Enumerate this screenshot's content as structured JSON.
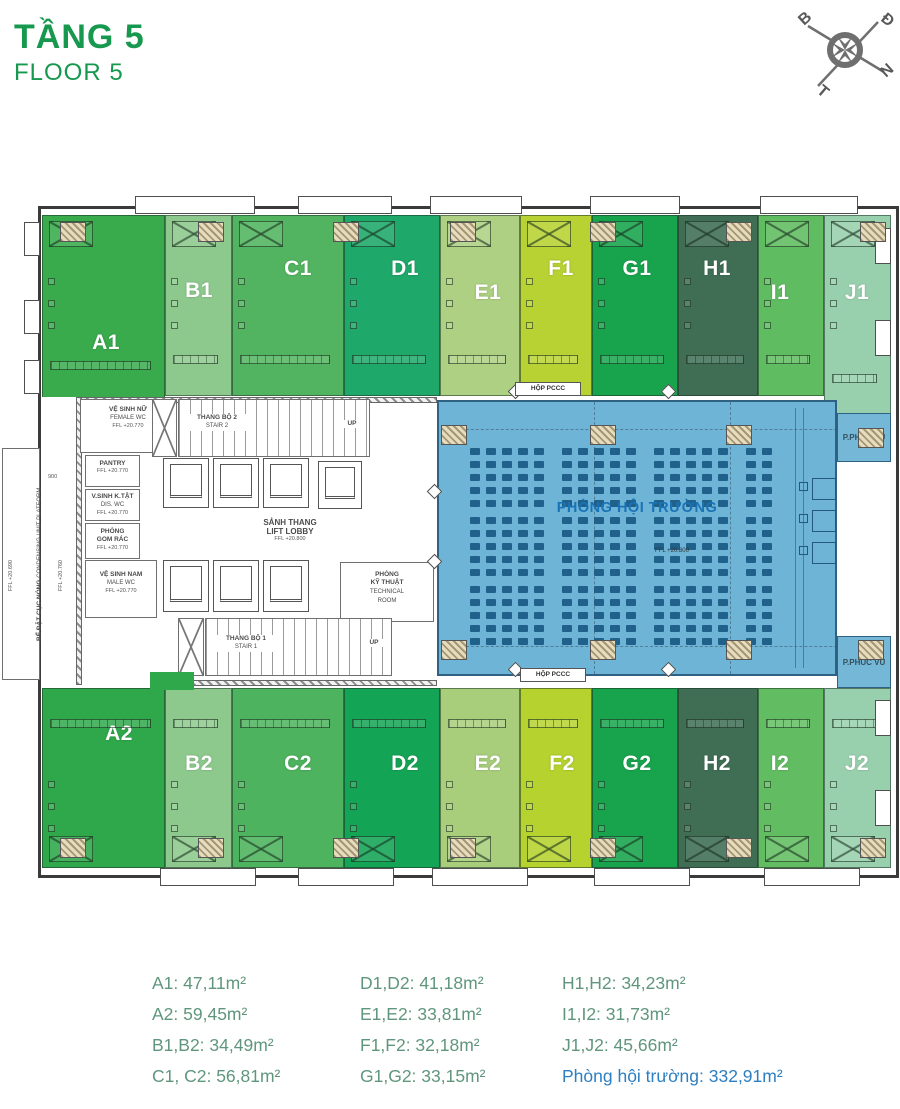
{
  "title": {
    "main": "TẦNG 5",
    "sub": "FLOOR 5",
    "color": "#16984f"
  },
  "compass": {
    "letters": [
      "B",
      "Đ",
      "N",
      "T"
    ]
  },
  "units": [
    {
      "id": "A1",
      "label": "A1",
      "color": "#39ab4d"
    },
    {
      "id": "B1",
      "label": "B1",
      "color": "#8dc98d"
    },
    {
      "id": "C1",
      "label": "C1",
      "color": "#52b460"
    },
    {
      "id": "D1",
      "label": "D1",
      "color": "#1ea86a"
    },
    {
      "id": "E1",
      "label": "E1",
      "color": "#aed083"
    },
    {
      "id": "F1",
      "label": "F1",
      "color": "#b8d233"
    },
    {
      "id": "G1",
      "label": "G1",
      "color": "#18a44d"
    },
    {
      "id": "H1",
      "label": "H1",
      "color": "#3f6e55"
    },
    {
      "id": "I1",
      "label": "I1",
      "color": "#60bc61"
    },
    {
      "id": "J1",
      "label": "J1",
      "color": "#98d0ad"
    },
    {
      "id": "A2",
      "label": "A2",
      "color": "#2fa84b"
    },
    {
      "id": "B2",
      "label": "B2",
      "color": "#8dc98d"
    },
    {
      "id": "C2",
      "label": "C2",
      "color": "#4db35e"
    },
    {
      "id": "D2",
      "label": "D2",
      "color": "#14a455"
    },
    {
      "id": "E2",
      "label": "E2",
      "color": "#a8ce7c"
    },
    {
      "id": "F2",
      "label": "F2",
      "color": "#b6d22f"
    },
    {
      "id": "G2",
      "label": "G2",
      "color": "#18a44d"
    },
    {
      "id": "H2",
      "label": "H2",
      "color": "#3f6e55"
    },
    {
      "id": "I2",
      "label": "I2",
      "color": "#62bd62"
    },
    {
      "id": "J2",
      "label": "J2",
      "color": "#98d0ad"
    }
  ],
  "hall": {
    "label": "PHÒNG HỘI TRƯỜNG",
    "ffl": "FFL +20.800",
    "color": "#6db4d6",
    "seat_color": "#20618c",
    "label_color": "#1a73b6",
    "service_color": "#74b7d7",
    "service_top": "P.PHUC VU",
    "service_bottom": "P.PHUC VU"
  },
  "core": {
    "female_wc": {
      "vi": "VỆ SINH NỮ",
      "en": "FEMALE WC",
      "ffl": "FFL +20.770"
    },
    "stair2": {
      "vi": "THANG BỘ 2",
      "en": "STAIR 2",
      "up": "UP"
    },
    "pantry": {
      "vi": "PANTRY",
      "ffl": "FFL +20.770"
    },
    "dis_wc": {
      "vi": "V.SINH K.TẬT",
      "en": "DIS. WC",
      "ffl": "FFL +20.770"
    },
    "gom_rac": {
      "vi1": "PHÒNG",
      "vi2": "GOM RÁC",
      "ffl": "FFL +20.770"
    },
    "lift_lobby": {
      "vi": "SẢNH THANG",
      "en": "LIFT LOBBY",
      "ffl": "FFL +20.800"
    },
    "male_wc": {
      "vi": "VỆ SINH NAM",
      "en": "MALE WC",
      "ffl": "FFL +20.770"
    },
    "technical": {
      "vi1": "PHÒNG",
      "vi2": "KỸ THUẬT",
      "en1": "TECHNICAL",
      "en2": "ROOM"
    },
    "stair1": {
      "vi": "THANG BỘ 1",
      "en": "STAIR 1",
      "up": "UP"
    },
    "condensing": {
      "vi": "BỂ ĐẶT CỤC NÓNG",
      "en": "CONDENSING UNIT PLATFORM"
    },
    "ffl_left1": "FFL +20.690",
    "ffl_left2": "FFL +20.760",
    "dim": "900"
  },
  "labels": {
    "hop_pccc_top": "HỘP PCCC",
    "hop_pccc_bottom": "HỘP PCCC"
  },
  "legend": {
    "color": "#5f967d",
    "highlight_color": "#2d7fc1",
    "col1": [
      "A1: 47,11m²",
      "A2: 59,45m²",
      "B1,B2: 34,49m²",
      "C1, C2: 56,81m²"
    ],
    "col2": [
      "D1,D2: 41,18m²",
      "E1,E2: 33,81m²",
      "F1,F2: 32,18m²",
      "G1,G2: 33,15m²"
    ],
    "col3": [
      "H1,H2: 34,23m²",
      "I1,I2: 31,73m²",
      "J1,J2: 45,66m²"
    ],
    "col3_highlight": "Phòng hội trường: 332,91m²"
  }
}
